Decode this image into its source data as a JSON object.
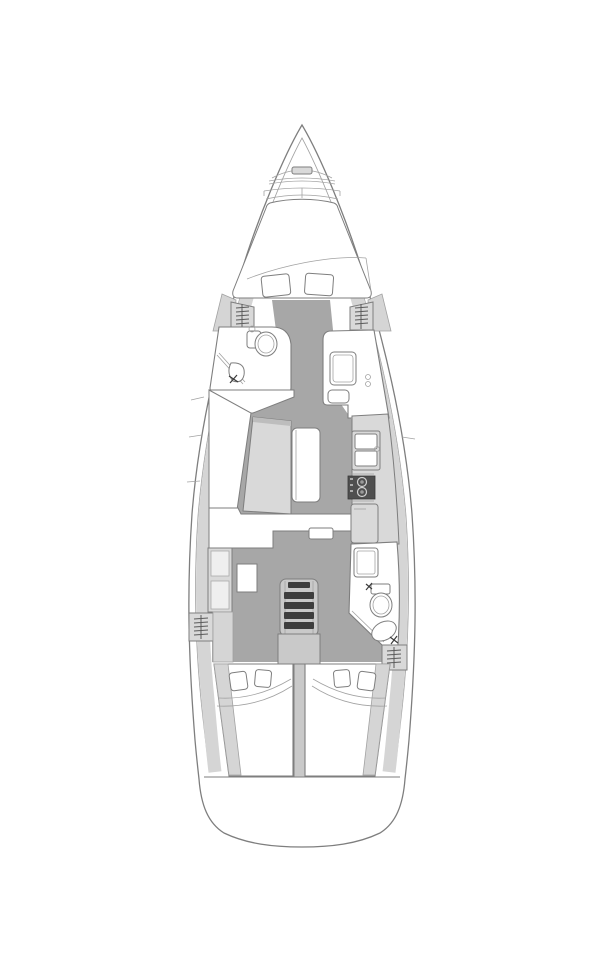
{
  "diagram": {
    "kind": "sailing-yacht-interior-floor-plan",
    "view": "top-down-bow-up",
    "colors": {
      "paper": "#ffffff",
      "line": "#7e7e7e",
      "lineSoft": "#a2a2a2",
      "band": "#d5d5d5",
      "floor": "#a7a7a7",
      "furnLight": "#d9d9d9",
      "furnMid": "#c9c9c9",
      "white": "#ffffff",
      "dark": "#4f4f4f",
      "tread": "#3d3d3d",
      "galleyStrip": "#9a9a9a"
    },
    "fixtures": [
      {
        "name": "bow-anchor-windlass-icon"
      },
      {
        "name": "v-berth-double-bed-icon",
        "pillows": 2
      },
      {
        "name": "hanging-locker-icon",
        "count": 4
      },
      {
        "name": "forward-head-toilet-icon"
      },
      {
        "name": "forward-head-sink-icon"
      },
      {
        "name": "shower-stall-icon"
      },
      {
        "name": "salon-settee-icon"
      },
      {
        "name": "salon-table-icon"
      },
      {
        "name": "galley-double-sink-icon"
      },
      {
        "name": "galley-stove-two-burner-icon"
      },
      {
        "name": "galley-fridge-icon"
      },
      {
        "name": "nav-cabinet-icon"
      },
      {
        "name": "companionway-steps-icon",
        "steps": 5
      },
      {
        "name": "aft-head-shower-icon"
      },
      {
        "name": "aft-head-toilet-icon"
      },
      {
        "name": "aft-head-sink-icon"
      },
      {
        "name": "aft-cabin-double-bed-icon",
        "count": 2,
        "pillows_each": 2
      },
      {
        "name": "transom-icon"
      }
    ]
  }
}
